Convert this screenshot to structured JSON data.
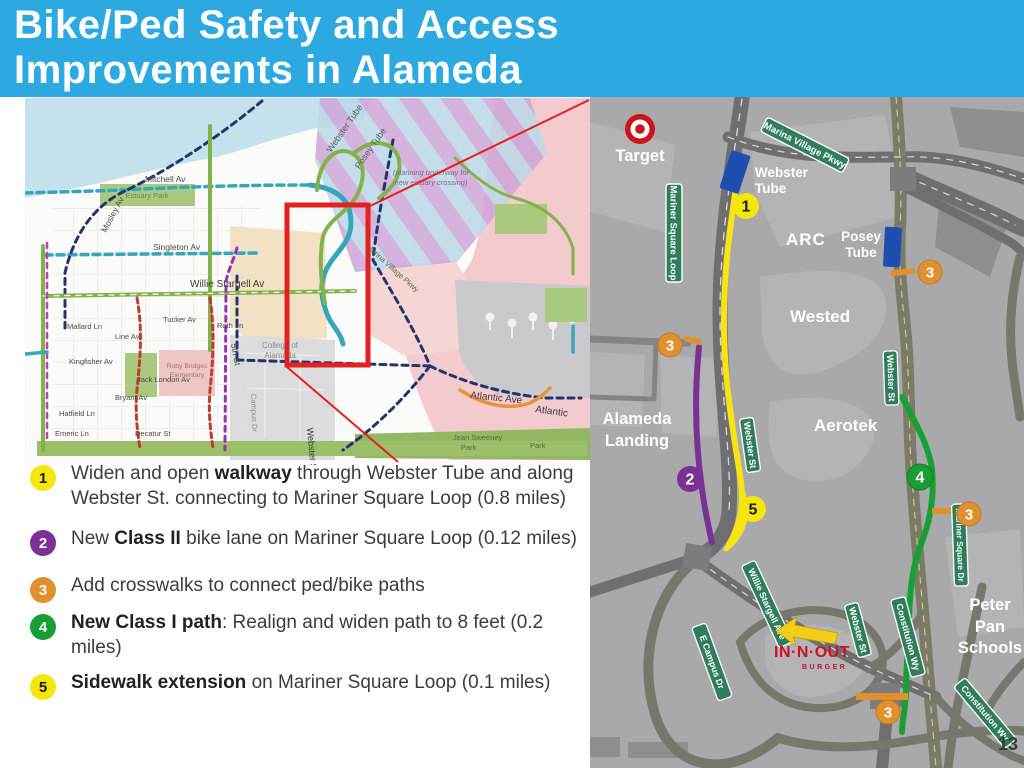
{
  "header": {
    "title_line1": "Bike/Ped Safety and Access",
    "title_line2": "Improvements in Alameda"
  },
  "page_number": "13",
  "improvements": [
    {
      "num": "1",
      "pre": "Widen and open ",
      "bold": "walkway",
      "post": " through Webster Tube and along Webster St. connecting to Mariner Square Loop (0.8 miles)"
    },
    {
      "num": "2",
      "pre": "New ",
      "bold": "Class II",
      "post": " bike lane on Mariner Square Loop (0.12 miles)"
    },
    {
      "num": "3",
      "pre": "",
      "bold": "",
      "post": "Add crosswalks to connect ped/bike paths"
    },
    {
      "num": "4",
      "pre": "",
      "bold": "New Class I path",
      "post": ": Realign and widen path to 8 feet (0.2 miles)"
    },
    {
      "num": "5",
      "pre": "",
      "bold": "Sidewalk extension",
      "post": " on Mariner Square Loop (0.1 miles)"
    }
  ],
  "colors": {
    "header_blue": "#2BA9E0",
    "badge_yellow": "#F4E60E",
    "badge_purple": "#7A3193",
    "badge_orange": "#E0912F",
    "badge_green": "#189E35",
    "route_yellow": "#F7E414",
    "highlight_red": "#E62020"
  },
  "overview_map": {
    "labels": {
      "mitchell": "Mitchell Av",
      "mosley": "Mosley Av",
      "singleton": "Singleton Av",
      "willie_stargell": "Willie Stargell Av",
      "mallard": "Mallard Ln",
      "line_av": "Line Av",
      "tucker": "Tucker Av",
      "roth": "Roth Ln",
      "fifth": "5th St",
      "kingfisher": "Kingfisher Av",
      "jack_london": "Jack London Av",
      "bryant": "Bryant Av",
      "hatfield": "Hatfield Ln",
      "emeric": "Emeric Ln",
      "decatur": "Decatur St",
      "college_1": "College of",
      "college_2": "Alameda",
      "campus": "Campus Dr",
      "webster_st": "Webster St",
      "atlantic_ave": "Atlantic Ave",
      "atlantic": "Atlantic",
      "estuary_park": "Estuary Park",
      "ruby_1": "Ruby Bridges",
      "ruby_2": "Elementary",
      "webster_tube": "Webster Tube",
      "posey_tube": "Posey Tube",
      "planning_1": "(planning underway for",
      "planning_2": "new estuary crossing)",
      "marina_village": "Marina Village Pkwy",
      "jean_sweeney": "Jean Sweeney",
      "park_a": "Park",
      "park_b": "Park"
    }
  },
  "detail_map": {
    "labels": {
      "target": "Target",
      "webster_tube_1": "Webster",
      "webster_tube_2": "Tube",
      "arc": "ARC",
      "posey_1": "Posey",
      "posey_2": "Tube",
      "wested": "Wested",
      "alameda_1": "Alameda",
      "alameda_2": "Landing",
      "aerotek": "Aerotek",
      "peter_1": "Peter",
      "peter_2": "Pan",
      "peter_3": "Schools",
      "innout_1": "IN·N·OUT",
      "innout_2": "BURGER"
    },
    "signs": {
      "marina_village": "Marina Village Pkwy",
      "mariner_square_loop": "Mariner Square Loop",
      "webster_st": "Webster St",
      "willie_stargell": "Willie Stargell Ave",
      "constitution": "Constitution Wy",
      "e_campus": "E Campus Dr",
      "mariner_square_dr": "Mariner Square Dr"
    },
    "badges": {
      "b1": "1",
      "b2": "2",
      "b3": "3",
      "b4": "4",
      "b5": "5"
    }
  }
}
